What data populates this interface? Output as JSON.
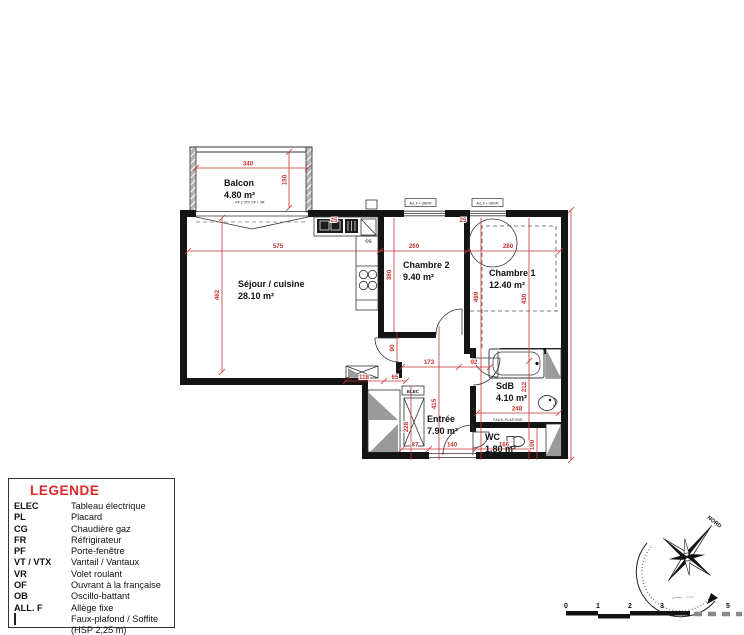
{
  "plan": {
    "rooms": [
      {
        "name": "Balcon",
        "area": "4.80 m²"
      },
      {
        "name": "Séjour / cuisine",
        "area": "28.10 m²"
      },
      {
        "name": "Chambre 2",
        "area": "9.40 m²"
      },
      {
        "name": "Chambre 1",
        "area": "12.40 m²"
      },
      {
        "name": "Entrée",
        "area": "7.90 m²"
      },
      {
        "name": "SdB",
        "area": "4.10 m²"
      },
      {
        "name": "WC",
        "area": "1.80 m²"
      }
    ],
    "dims": {
      "balcon_w": "340",
      "balcon_d": "150",
      "sejour_w": "575",
      "ch2_w": "260",
      "ch1_w": "280",
      "sejour_h": "462",
      "ch2_h": "360",
      "ch1_h1": "499",
      "ch1_h2": "430",
      "sdb_h": "212",
      "win_off1": "25",
      "win_off2": "25",
      "door90": "90",
      "hall1": "173",
      "hall2": "92",
      "entree_h": "415",
      "pl_h": "228",
      "seg118": "118",
      "seg65": "65",
      "bot87": "87",
      "entry_door": "140",
      "sdb_w": "248",
      "wc_w": "166",
      "wc_h": "100"
    },
    "tiny": {
      "balcony_door": "PF 2 VTX OF + VR",
      "window": "ALL.F + OB/VR",
      "elec": "ELEC",
      "cg": "CG",
      "soffit": "FAUX-PLAFOND"
    }
  },
  "legend": {
    "title": "LEGENDE",
    "items": [
      {
        "abbr": "ELEC",
        "desc": "Tableau électrique"
      },
      {
        "abbr": "PL",
        "desc": "Placard"
      },
      {
        "abbr": "CG",
        "desc": "Chaudière gaz"
      },
      {
        "abbr": "FR",
        "desc": "Réfrigirateur"
      },
      {
        "abbr": "PF",
        "desc": "Porte-fenêtre"
      },
      {
        "abbr": "VT / VTX",
        "desc": "Vantail / Vantaux"
      },
      {
        "abbr": "VR",
        "desc": "Volet roulant"
      },
      {
        "abbr": "OF",
        "desc": "Ouvrant à la française"
      },
      {
        "abbr": "OB",
        "desc": "Oscillo-battant"
      },
      {
        "abbr": "ALL. F",
        "desc": "Allège fixe"
      },
      {
        "abbr": "",
        "desc": "Faux-plafond / Soffite (HSP 2,25 m)"
      }
    ]
  },
  "compass": {
    "north": "NORD"
  },
  "scalebar": {
    "ticks": [
      "0",
      "1",
      "2",
      "3",
      "5"
    ]
  }
}
